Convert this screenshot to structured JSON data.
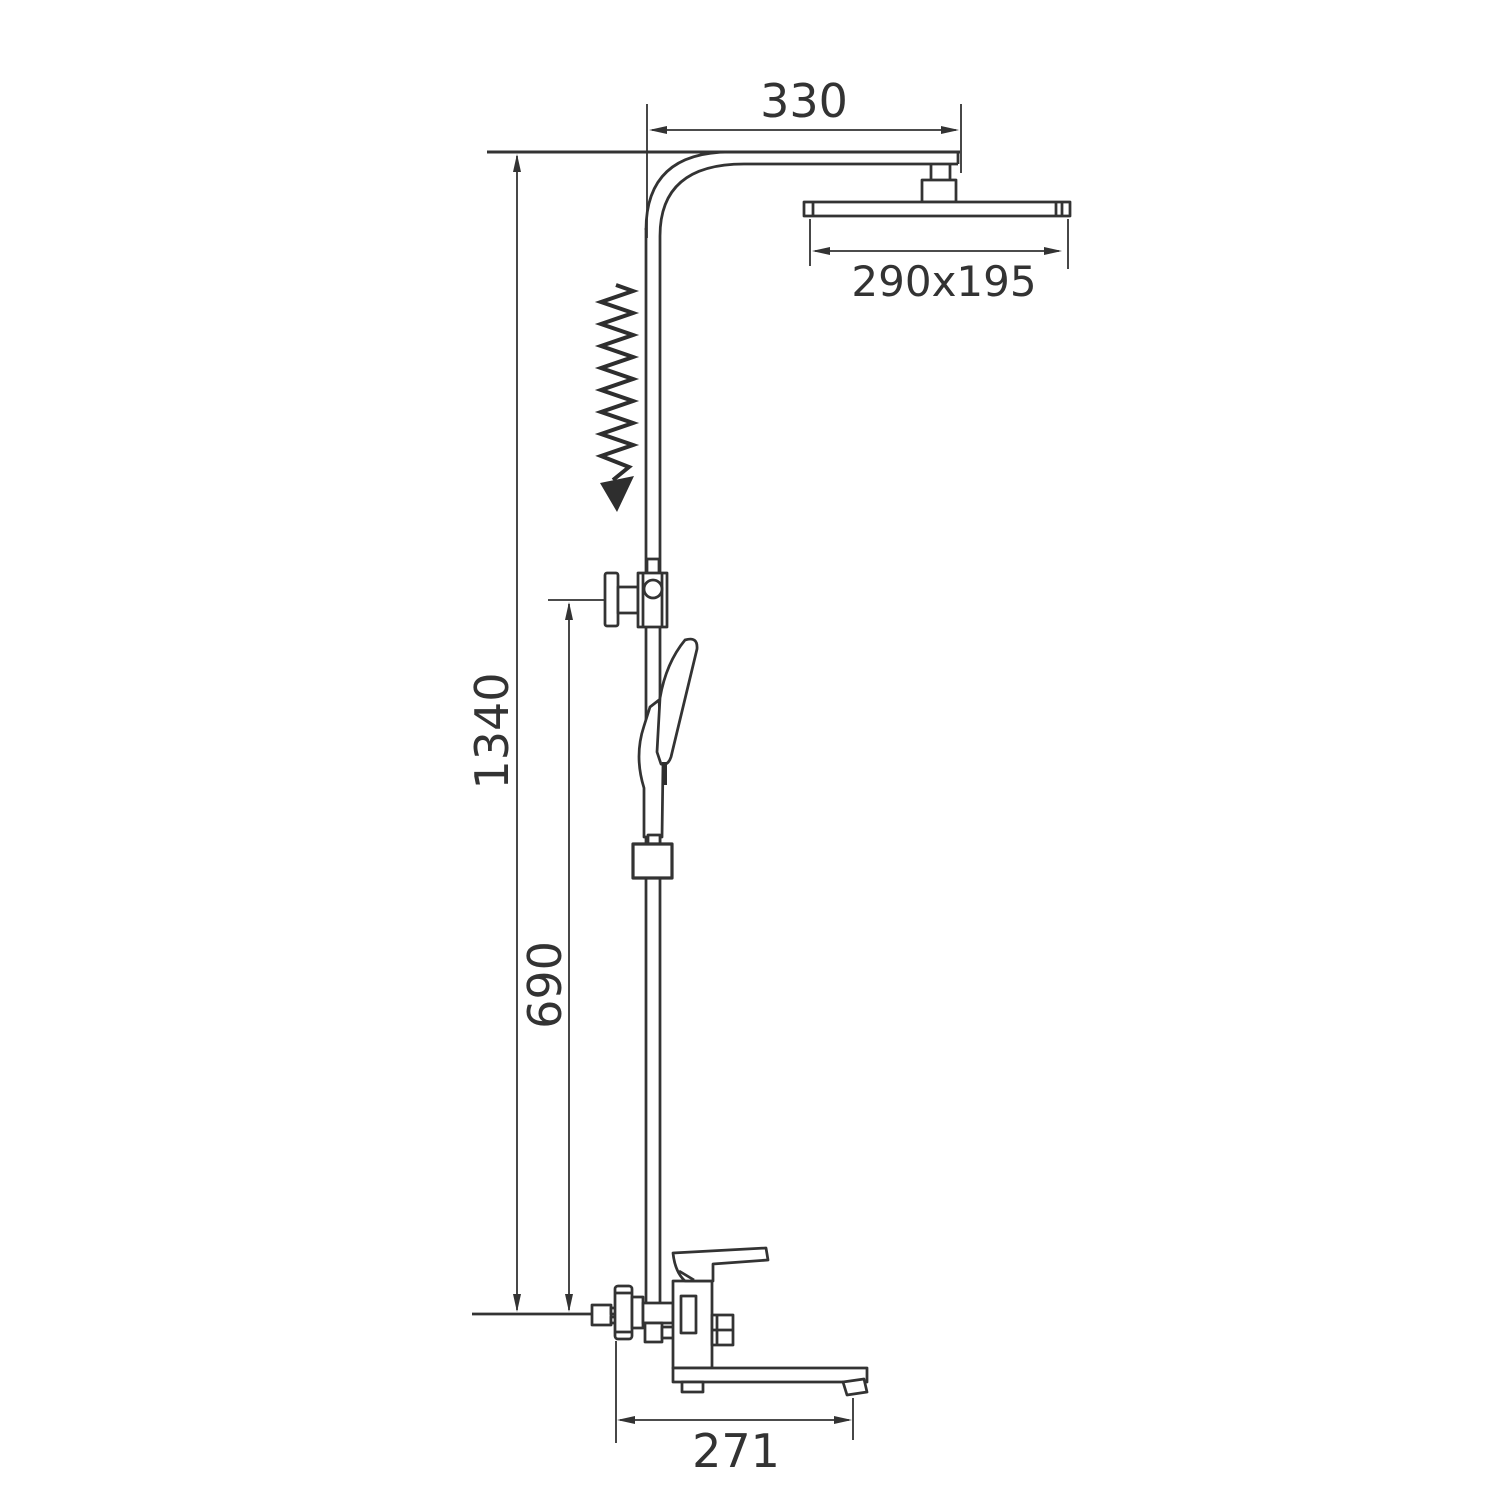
{
  "drawing": {
    "type": "shower-system-dimensional-drawing",
    "background_color": "#ffffff",
    "line_color": "#333333",
    "labels": {
      "arm_offset": "330",
      "head_dimensions": "290x195",
      "overall_height": "1340",
      "slider_height": "690",
      "spout_reach": "271"
    }
  }
}
